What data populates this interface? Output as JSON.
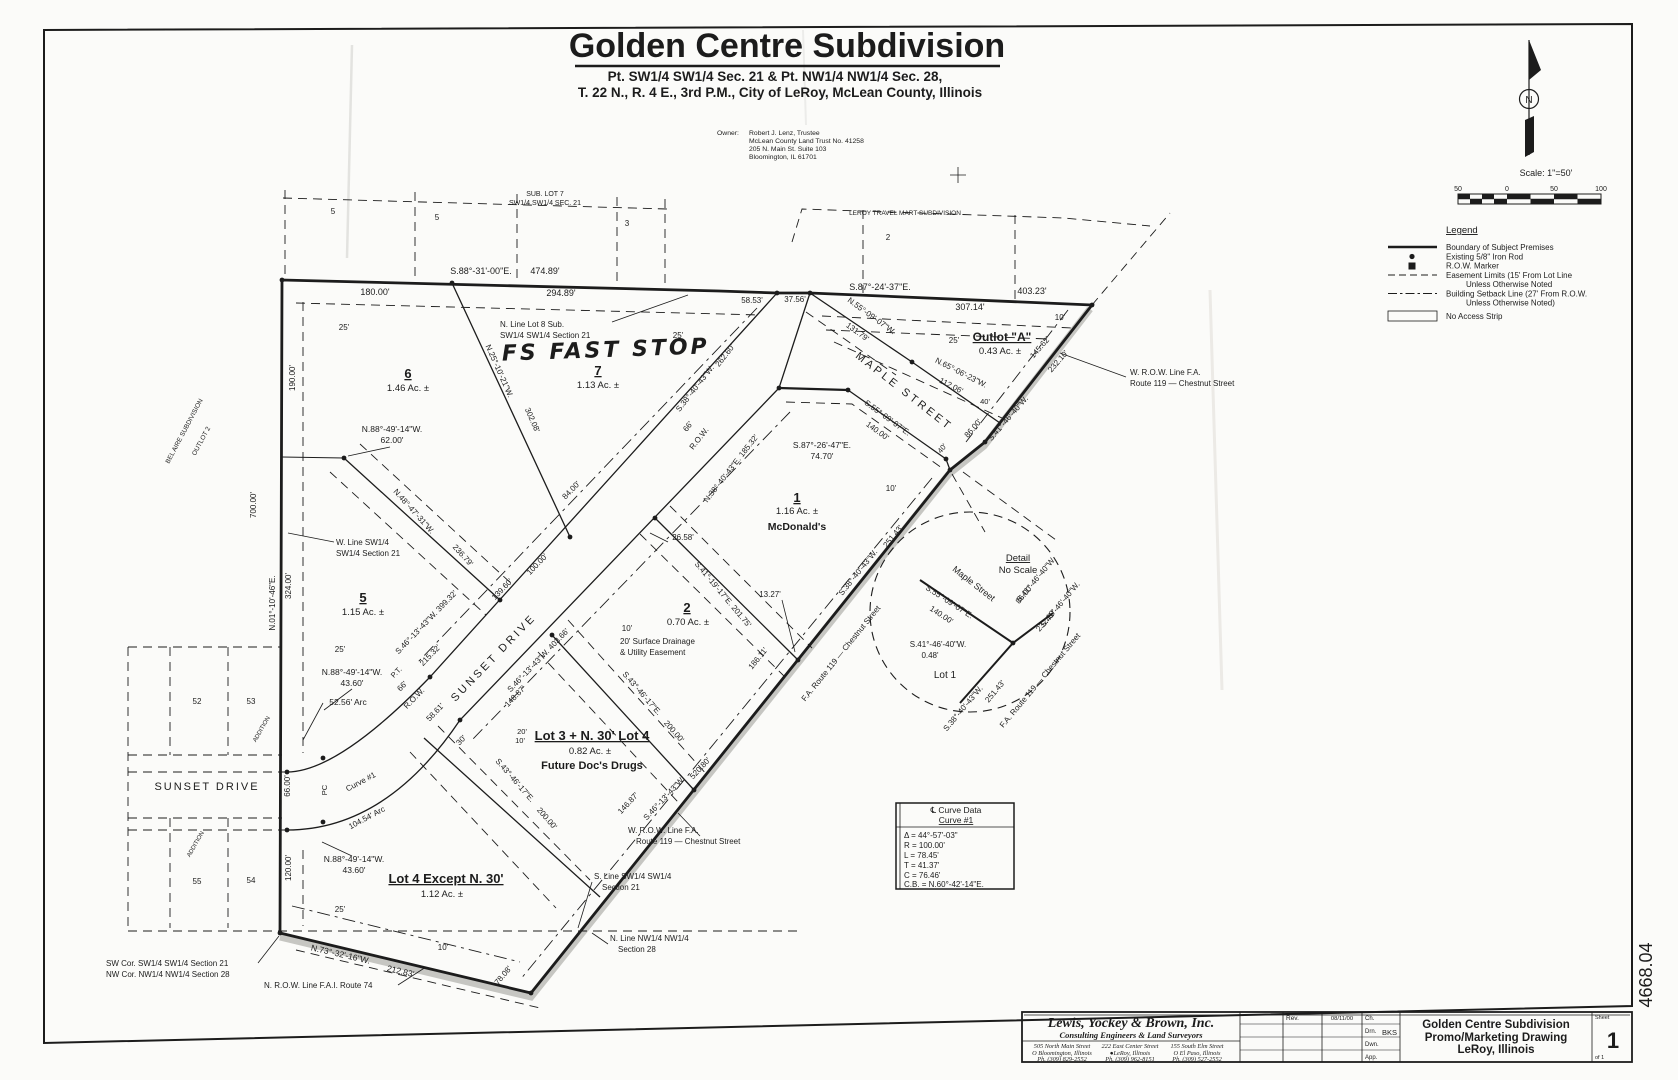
{
  "header": {
    "title": "Golden Centre Subdivision",
    "subtitle1": "Pt. SW1/4 SW1/4 Sec. 21 & Pt. NW1/4 NW1/4 Sec. 28,",
    "subtitle2": "T. 22 N., R. 4 E., 3rd P.M., City of LeRoy, McLean County, Illinois",
    "owner_label": "Owner:",
    "owner_lines": [
      "Robert J. Lenz, Trustee",
      "McLean County Land Trust No. 41258",
      "205 N. Main St. Suite 103",
      "Bloomington, IL  61701"
    ]
  },
  "north_arrow": {
    "label": "N"
  },
  "scale": {
    "text": "Scale:  1\"=50'",
    "ticks": [
      "50",
      "0",
      "50",
      "100"
    ]
  },
  "legend": {
    "title": "Legend",
    "items": [
      {
        "label": "Boundary of Subject Premises"
      },
      {
        "label": "Existing 5/8\" Iron Rod"
      },
      {
        "label": "R.O.W. Marker"
      },
      {
        "label": "Easement Limits (15' From Lot Line",
        "label2": "Unless Otherwise Noted"
      },
      {
        "label": "Building Setback Line (27' From R.O.W.",
        "label2": "Unless Otherwise Noted)"
      },
      {
        "label": "No Access Strip"
      }
    ]
  },
  "curve_table": {
    "title": "℄ Curve Data",
    "subtitle": "Curve #1",
    "rows": [
      "Δ = 44°-57'-03\"",
      "R = 100.00'",
      "L = 78.45'",
      "T = 41.37'",
      "C = 76.46'",
      "C.B. = N.60°-42'-14\"E."
    ]
  },
  "title_block": {
    "firm": "Lewis, Yockey & Brown, Inc.",
    "firm_sub": "Consulting Engineers & Land Surveyors",
    "offices": [
      {
        "street": "505 North Main Street",
        "city": "O Bloomington, Illinois",
        "phone": "Ph. (309) 829-2552"
      },
      {
        "street": "222 East Center Street",
        "city": "●LeRoy, Illinois",
        "phone": "Ph. (309) 962-8151"
      },
      {
        "street": "155 South Elm Street",
        "city": "O El Paso, Illinois",
        "phone": "Ph. (309) 527-2552"
      }
    ],
    "rev_label": "Rev.",
    "rev_date": "08/11/00",
    "sign_rows": [
      {
        "label": "Ch.",
        "value": ""
      },
      {
        "label": "Drn.",
        "value": "BKS"
      },
      {
        "label": "Dwn.",
        "value": ""
      },
      {
        "label": "App.",
        "value": ""
      }
    ],
    "project_title": [
      "Golden Centre Subdivision",
      "Promo/Marketing Drawing",
      "LeRoy, Illinois"
    ],
    "sheet_label": "Sheet",
    "sheet_number": "1",
    "sheet_of": "of 1",
    "job_number": "4668.04"
  },
  "plat": {
    "labels": [
      {
        "t": "SUB. LOT 7",
        "x": 545,
        "y": 196,
        "s": 7
      },
      {
        "t": "SW1/4  SW1/4  SEC. 21",
        "x": 545,
        "y": 205,
        "s": 7
      },
      {
        "t": "5",
        "x": 333,
        "y": 214,
        "s": 8
      },
      {
        "t": "5",
        "x": 437,
        "y": 220,
        "s": 8
      },
      {
        "t": "3",
        "x": 627,
        "y": 226,
        "s": 8
      },
      {
        "t": "LEROY TRAVEL MART SUBDIVISION",
        "x": 905,
        "y": 215,
        "s": 6.5
      },
      {
        "t": "2",
        "x": 888,
        "y": 240,
        "s": 8
      },
      {
        "t": "S.88°-31'-00\"E.",
        "x": 481,
        "y": 274,
        "s": 9
      },
      {
        "t": "474.89'",
        "x": 545,
        "y": 274,
        "s": 9
      },
      {
        "t": "180.00'",
        "x": 375,
        "y": 295,
        "s": 9
      },
      {
        "t": "294.89'",
        "x": 561,
        "y": 296,
        "s": 9
      },
      {
        "t": "58.53'",
        "x": 752,
        "y": 303,
        "s": 8
      },
      {
        "t": "37.56'",
        "x": 795,
        "y": 302,
        "s": 8
      },
      {
        "t": "S.87°-24'-37\"E.",
        "x": 880,
        "y": 290,
        "s": 9
      },
      {
        "t": "403.23'",
        "x": 1032,
        "y": 294,
        "s": 9
      },
      {
        "t": "307.14'",
        "x": 970,
        "y": 310,
        "s": 9
      },
      {
        "t": "N. Line Lot 8 Sub.",
        "x": 500,
        "y": 327,
        "s": 8,
        "a": "start"
      },
      {
        "t": "SW1/4 SW1/4 Section 21",
        "x": 500,
        "y": 338,
        "s": 8,
        "a": "start"
      },
      {
        "t": "FS FAST STOP",
        "x": 606,
        "y": 357,
        "s": 22,
        "hand": 1,
        "r": -2
      },
      {
        "t": "6",
        "x": 408,
        "y": 378,
        "s": 13,
        "w": 1,
        "u": 1
      },
      {
        "t": "1.46  Ac. ±",
        "x": 408,
        "y": 391,
        "s": 9.5
      },
      {
        "t": "7",
        "x": 598,
        "y": 375,
        "s": 13,
        "w": 1,
        "u": 1
      },
      {
        "t": "1.13  Ac. ±",
        "x": 598,
        "y": 388,
        "s": 9.5
      },
      {
        "t": "25'",
        "x": 344,
        "y": 330,
        "s": 8
      },
      {
        "t": "25'",
        "x": 678,
        "y": 338,
        "s": 8
      },
      {
        "t": "N.25°-10'-21\"W.",
        "x": 497,
        "y": 372,
        "r": 66,
        "s": 8
      },
      {
        "t": "302.08'",
        "x": 530,
        "y": 421,
        "r": 66,
        "s": 8
      },
      {
        "t": "190.00'",
        "x": 295,
        "y": 378,
        "r": -90,
        "s": 8
      },
      {
        "t": "700.00'",
        "x": 256,
        "y": 505,
        "r": -90,
        "s": 8
      },
      {
        "t": "324.00'",
        "x": 291,
        "y": 586,
        "r": -90,
        "s": 8
      },
      {
        "t": "N.01°-10'-46\"E.",
        "x": 275,
        "y": 603,
        "r": -90,
        "s": 8
      },
      {
        "t": "BEL AIRE SUBDIVISION",
        "x": 186,
        "y": 432,
        "r": -62,
        "s": 6.5
      },
      {
        "t": "OUTLOT 2",
        "x": 203,
        "y": 442,
        "r": -62,
        "s": 6.5
      },
      {
        "t": "N.88°-49'-14\"W.",
        "x": 392,
        "y": 432,
        "s": 8.5
      },
      {
        "t": "62.00'",
        "x": 392,
        "y": 443,
        "s": 8.5
      },
      {
        "t": "W. Line SW1/4",
        "x": 336,
        "y": 545,
        "s": 8,
        "a": "start"
      },
      {
        "t": "SW1/4 Section 21",
        "x": 336,
        "y": 556,
        "s": 8,
        "a": "start"
      },
      {
        "t": "N.48°-47'-31\"W.",
        "x": 412,
        "y": 513,
        "r": 48,
        "s": 8
      },
      {
        "t": "236.79'",
        "x": 461,
        "y": 557,
        "r": 48,
        "s": 8
      },
      {
        "t": "5",
        "x": 363,
        "y": 602,
        "s": 13,
        "w": 1,
        "u": 1
      },
      {
        "t": "1.15  Ac. ±",
        "x": 363,
        "y": 615,
        "s": 9.5
      },
      {
        "t": "84.00'",
        "x": 573,
        "y": 492,
        "r": -46,
        "s": 8
      },
      {
        "t": "100.00'",
        "x": 539,
        "y": 566,
        "r": -46,
        "s": 8
      },
      {
        "t": "SUNSET  DRIVE",
        "x": 496,
        "y": 660,
        "r": -46,
        "s": 11,
        "ls": 3
      },
      {
        "t": "S.46°-13'-43\"W.  399.32'",
        "x": 428,
        "y": 624,
        "r": -46,
        "s": 8
      },
      {
        "t": "S.46°-13'-43\"W.  403.66'",
        "x": 540,
        "y": 662,
        "r": -46,
        "s": 8
      },
      {
        "t": "148.87'",
        "x": 517,
        "y": 698,
        "r": -46,
        "s": 8
      },
      {
        "t": "139.60'",
        "x": 504,
        "y": 591,
        "r": -46,
        "s": 8
      },
      {
        "t": "215.32'",
        "x": 432,
        "y": 657,
        "r": -46,
        "s": 8
      },
      {
        "t": "58.61'",
        "x": 437,
        "y": 714,
        "r": -46,
        "s": 8
      },
      {
        "t": "66'",
        "x": 404,
        "y": 688,
        "r": -46,
        "s": 8
      },
      {
        "t": "R.O.W.",
        "x": 416,
        "y": 700,
        "r": -46,
        "s": 8
      },
      {
        "t": "P.T.",
        "x": 398,
        "y": 674,
        "r": -46,
        "s": 7.5
      },
      {
        "t": "30'",
        "x": 463,
        "y": 742,
        "r": -46,
        "s": 8
      },
      {
        "t": "2",
        "x": 687,
        "y": 612,
        "s": 13,
        "w": 1,
        "u": 1
      },
      {
        "t": "0.70  Ac. ±",
        "x": 688,
        "y": 625,
        "s": 9.5
      },
      {
        "t": "10'",
        "x": 627,
        "y": 631,
        "s": 8
      },
      {
        "t": "20' Surface Drainage",
        "x": 620,
        "y": 644,
        "s": 8,
        "a": "start"
      },
      {
        "t": "& Utility Easement",
        "x": 620,
        "y": 655,
        "s": 8,
        "a": "start"
      },
      {
        "t": "26.58'",
        "x": 683,
        "y": 540,
        "s": 8
      },
      {
        "t": "13.27'",
        "x": 770,
        "y": 597,
        "s": 8
      },
      {
        "t": "S.41°-19'-17\"E.  201.75'",
        "x": 721,
        "y": 596,
        "r": 50,
        "s": 8
      },
      {
        "t": "1",
        "x": 797,
        "y": 502,
        "s": 13,
        "w": 1,
        "u": 1
      },
      {
        "t": "1.16  Ac. ±",
        "x": 797,
        "y": 514,
        "s": 9.5
      },
      {
        "t": "McDonald's",
        "x": 797,
        "y": 530,
        "s": 10.5,
        "w": 1
      },
      {
        "t": "S.87°-26'-47\"E.",
        "x": 822,
        "y": 448,
        "s": 8.5
      },
      {
        "t": "74.70'",
        "x": 822,
        "y": 459,
        "s": 8.5
      },
      {
        "t": "N.38°-40'-43\"E.  185.32'",
        "x": 733,
        "y": 470,
        "r": -52,
        "s": 8
      },
      {
        "t": "S.38°-40'-43\"W.",
        "x": 697,
        "y": 390,
        "r": -52,
        "s": 8
      },
      {
        "t": "262.60'",
        "x": 727,
        "y": 357,
        "r": -52,
        "s": 8
      },
      {
        "t": "66'",
        "x": 690,
        "y": 428,
        "r": -52,
        "s": 8
      },
      {
        "t": "R.O.W.",
        "x": 701,
        "y": 440,
        "r": -52,
        "s": 8
      },
      {
        "t": "MAPLE  STREET",
        "x": 902,
        "y": 394,
        "r": 38,
        "s": 11,
        "ls": 3
      },
      {
        "t": "N.55°-09'-07\"W.",
        "x": 870,
        "y": 318,
        "r": 36,
        "s": 8
      },
      {
        "t": "131.79'",
        "x": 856,
        "y": 334,
        "r": 36,
        "s": 8
      },
      {
        "t": "N.65°-06'-23\"W.",
        "x": 960,
        "y": 375,
        "r": 27,
        "s": 8
      },
      {
        "t": "112.06'",
        "x": 950,
        "y": 388,
        "r": 27,
        "s": 8
      },
      {
        "t": "S.55°-09'-07\"E.",
        "x": 886,
        "y": 420,
        "r": 36,
        "s": 8
      },
      {
        "t": "140.00'",
        "x": 876,
        "y": 433,
        "r": 36,
        "s": 8
      },
      {
        "t": "40'",
        "x": 985,
        "y": 404,
        "s": 7.5
      },
      {
        "t": "40'",
        "x": 944,
        "y": 450,
        "r": -50,
        "s": 7.5
      },
      {
        "t": "Outlot \"A\"",
        "x": 1002,
        "y": 341,
        "s": 12,
        "w": 1,
        "u": 1
      },
      {
        "t": "0.43  Ac. ±",
        "x": 1000,
        "y": 354,
        "s": 9.5
      },
      {
        "t": "10'",
        "x": 1060,
        "y": 320,
        "s": 8
      },
      {
        "t": "25'",
        "x": 954,
        "y": 343,
        "s": 8
      },
      {
        "t": "145.62'",
        "x": 1042,
        "y": 349,
        "r": -49,
        "s": 8
      },
      {
        "t": "232.10'",
        "x": 1060,
        "y": 363,
        "r": -49,
        "s": 8
      },
      {
        "t": "S.41°-46'-40\"W.",
        "x": 1010,
        "y": 420,
        "r": -49,
        "s": 8
      },
      {
        "t": "86.00'",
        "x": 975,
        "y": 430,
        "r": -49,
        "s": 8
      },
      {
        "t": "W. R.O.W. Line F.A.",
        "x": 1130,
        "y": 375,
        "s": 8,
        "a": "start"
      },
      {
        "t": "Route 119 — Chestnut Street",
        "x": 1130,
        "y": 386,
        "s": 8,
        "a": "start"
      },
      {
        "t": "10'",
        "x": 891,
        "y": 491,
        "s": 8
      },
      {
        "t": "S.38°-40'-43\"W.",
        "x": 860,
        "y": 574,
        "r": -51,
        "s": 8
      },
      {
        "t": "251.43'",
        "x": 895,
        "y": 538,
        "r": -51,
        "s": 8
      },
      {
        "t": "186.11'",
        "x": 760,
        "y": 660,
        "r": -51,
        "s": 8
      },
      {
        "t": "F.A. Route 119 — Chestnut Street",
        "x": 843,
        "y": 655,
        "r": -51,
        "s": 8
      },
      {
        "t": "Lot 3 + N. 30' Lot 4",
        "x": 592,
        "y": 740,
        "s": 13,
        "w": 1,
        "u": 1
      },
      {
        "t": "0.82  Ac. ±",
        "x": 590,
        "y": 754,
        "s": 9.5
      },
      {
        "t": "Future Doc's Drugs",
        "x": 592,
        "y": 769,
        "s": 11,
        "w": 1
      },
      {
        "t": "20'",
        "x": 522,
        "y": 734,
        "s": 7.5
      },
      {
        "t": "10'",
        "x": 520,
        "y": 743,
        "s": 7.5
      },
      {
        "t": "S.43°-46'-17\"E.",
        "x": 640,
        "y": 695,
        "r": 49,
        "s": 8
      },
      {
        "t": "200.00'",
        "x": 672,
        "y": 733,
        "r": 49,
        "s": 8
      },
      {
        "t": "S.43°-46'-17\"E.",
        "x": 513,
        "y": 782,
        "r": 49,
        "s": 8
      },
      {
        "t": "200.00'",
        "x": 545,
        "y": 820,
        "r": 49,
        "s": 8
      },
      {
        "t": "S.46°-13'-43\"W.",
        "x": 666,
        "y": 800,
        "r": -47,
        "s": 8
      },
      {
        "t": "520.80'",
        "x": 702,
        "y": 770,
        "r": -47,
        "s": 8
      },
      {
        "t": "146.87'",
        "x": 630,
        "y": 805,
        "r": -47,
        "s": 8
      },
      {
        "t": "W. R.O.W. Line F.A.",
        "x": 628,
        "y": 833,
        "s": 8,
        "a": "start"
      },
      {
        "t": "Route 119 — Chestnut Street",
        "x": 636,
        "y": 844,
        "s": 8,
        "a": "start"
      },
      {
        "t": "Lot 4 Except N. 30'",
        "x": 446,
        "y": 883,
        "s": 13,
        "w": 1,
        "u": 1
      },
      {
        "t": "1.12  Ac. ±",
        "x": 442,
        "y": 897,
        "s": 9.5
      },
      {
        "t": "N.88°-49'-14\"W.",
        "x": 352,
        "y": 675,
        "s": 8.5
      },
      {
        "t": "43.60'",
        "x": 352,
        "y": 686,
        "s": 8.5
      },
      {
        "t": "52.56'  Arc",
        "x": 348,
        "y": 705,
        "s": 8.5
      },
      {
        "t": "Curve #1",
        "x": 362,
        "y": 784,
        "r": -28,
        "s": 8
      },
      {
        "t": "104.54'  Arc",
        "x": 368,
        "y": 820,
        "r": -28,
        "s": 8
      },
      {
        "t": "PC",
        "x": 327,
        "y": 790,
        "r": -90,
        "s": 7.5
      },
      {
        "t": "N.88°-49'-14\"W.",
        "x": 354,
        "y": 862,
        "s": 8.5
      },
      {
        "t": "43.60'",
        "x": 354,
        "y": 873,
        "s": 8.5
      },
      {
        "t": "66.00'",
        "x": 290,
        "y": 786,
        "r": -90,
        "s": 8
      },
      {
        "t": "120.00'",
        "x": 291,
        "y": 868,
        "r": -90,
        "s": 8
      },
      {
        "t": "25'",
        "x": 340,
        "y": 652,
        "s": 8
      },
      {
        "t": "25'",
        "x": 340,
        "y": 912,
        "s": 8
      },
      {
        "t": "52",
        "x": 197,
        "y": 704,
        "s": 8
      },
      {
        "t": "53",
        "x": 251,
        "y": 704,
        "s": 8
      },
      {
        "t": "55",
        "x": 197,
        "y": 884,
        "s": 8
      },
      {
        "t": "54",
        "x": 251,
        "y": 883,
        "s": 8
      },
      {
        "t": "SUNSET  DRIVE",
        "x": 207,
        "y": 790,
        "s": 11,
        "ls": 2
      },
      {
        "t": "ADDITION",
        "x": 263,
        "y": 730,
        "r": -60,
        "s": 6
      },
      {
        "t": "ADDITION",
        "x": 197,
        "y": 845,
        "r": -60,
        "s": 6
      },
      {
        "t": "SW Cor. SW1/4 SW1/4 Section 21",
        "x": 106,
        "y": 966,
        "s": 8,
        "a": "start"
      },
      {
        "t": "NW Cor. NW1/4 NW1/4 Section 28",
        "x": 106,
        "y": 977,
        "s": 8,
        "a": "start"
      },
      {
        "t": "N.73°-32'-16\"W.",
        "x": 340,
        "y": 957,
        "r": 13,
        "s": 8.5
      },
      {
        "t": "212.83'",
        "x": 400,
        "y": 974,
        "r": 13,
        "s": 8.5
      },
      {
        "t": "10'",
        "x": 443,
        "y": 950,
        "s": 8
      },
      {
        "t": "78.08'",
        "x": 505,
        "y": 977,
        "r": -50,
        "s": 8
      },
      {
        "t": "N. R.O.W. Line F.A.I. Route 74",
        "x": 264,
        "y": 988,
        "s": 8,
        "a": "start"
      },
      {
        "t": "S. Line SW1/4 SW1/4",
        "x": 594,
        "y": 879,
        "s": 8,
        "a": "start"
      },
      {
        "t": "Section 21",
        "x": 602,
        "y": 890,
        "s": 8,
        "a": "start"
      },
      {
        "t": "N. Line NW1/4 NW1/4",
        "x": 610,
        "y": 941,
        "s": 8,
        "a": "start"
      },
      {
        "t": "Section 28",
        "x": 618,
        "y": 952,
        "s": 8,
        "a": "start"
      },
      {
        "t": "Detail",
        "x": 1018,
        "y": 561,
        "s": 9.5,
        "u": 1
      },
      {
        "t": "No Scale",
        "x": 1018,
        "y": 573,
        "s": 9.5
      },
      {
        "t": "Maple Street",
        "x": 972,
        "y": 586,
        "r": 38,
        "s": 9
      },
      {
        "t": "S.55°-09'-07\"E.",
        "x": 948,
        "y": 604,
        "r": 33,
        "s": 8
      },
      {
        "t": "140.00'",
        "x": 940,
        "y": 617,
        "r": 33,
        "s": 8
      },
      {
        "t": "S.41°-46'-40\"W.",
        "x": 1038,
        "y": 581,
        "r": -50,
        "s": 8
      },
      {
        "t": "86.00'",
        "x": 1026,
        "y": 596,
        "r": -50,
        "s": 8
      },
      {
        "t": "S.41°-46'-40\"W.",
        "x": 1062,
        "y": 606,
        "r": -50,
        "s": 8
      },
      {
        "t": "232.10'",
        "x": 1048,
        "y": 622,
        "r": -50,
        "s": 8
      },
      {
        "t": "S.41°-46'-40\"W.",
        "x": 938,
        "y": 647,
        "s": 8
      },
      {
        "t": "0.48'",
        "x": 930,
        "y": 658,
        "s": 8
      },
      {
        "t": "Lot 1",
        "x": 945,
        "y": 678,
        "s": 10
      },
      {
        "t": "S.38°-40'-43\"W.",
        "x": 965,
        "y": 710,
        "r": -50,
        "s": 8
      },
      {
        "t": "251.43'",
        "x": 997,
        "y": 693,
        "r": -50,
        "s": 8
      },
      {
        "t": "F.A. Route 119 — Chestnut Street",
        "x": 1042,
        "y": 682,
        "r": -50,
        "s": 8
      }
    ]
  }
}
